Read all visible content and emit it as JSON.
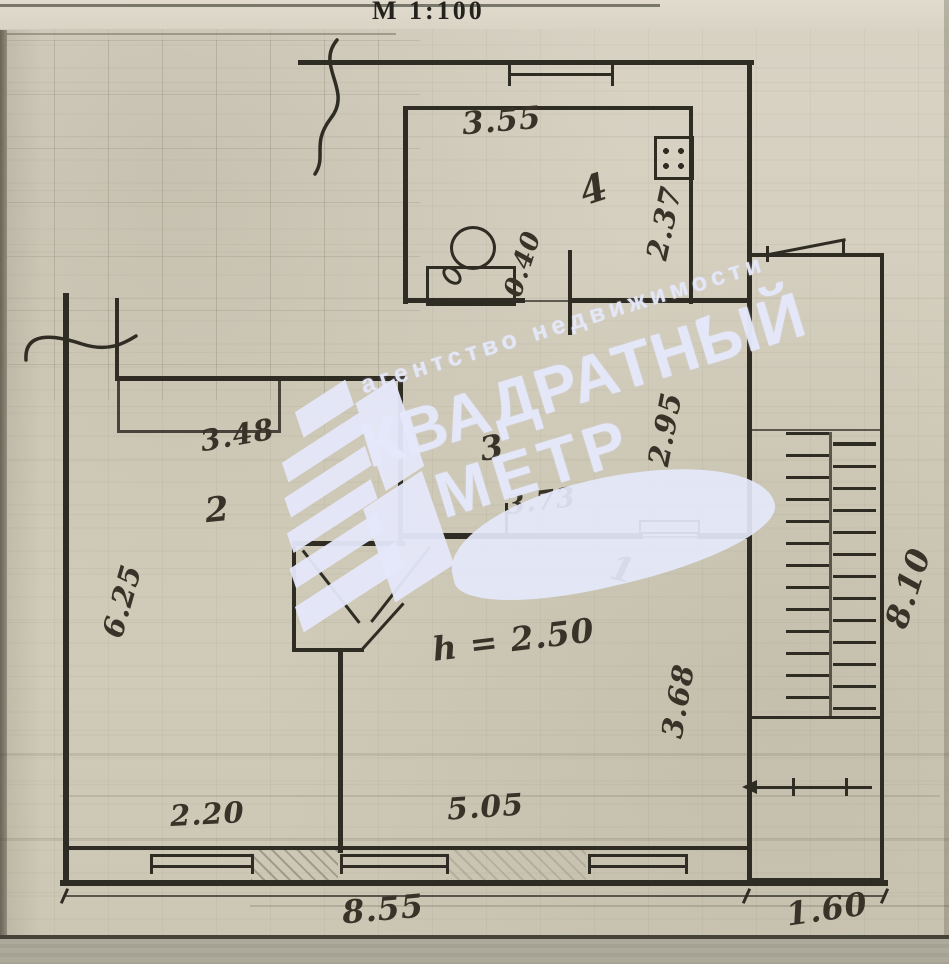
{
  "scale_label": "М 1:100",
  "watermark": {
    "agency_line": "агентство недвижимости",
    "brand_line1": "КВАДРАТНЫЙ",
    "brand_line2": "МЕТР",
    "color": "#e5e8fa"
  },
  "plan": {
    "ceiling_height_note": "h = 2.50",
    "rooms": [
      {
        "number": "1"
      },
      {
        "number": "2"
      },
      {
        "number": "3"
      },
      {
        "number": "4"
      }
    ],
    "dims": {
      "kitchen_width": "3.55",
      "kitchen_depth": "2.37",
      "duct_width": "0.40",
      "hall_depth": "2.95",
      "hall_width": "3.73",
      "room2_width": "3.48",
      "room2_depth": "6.25",
      "room1_width": "5.05",
      "room1_depth": "3.68",
      "room2_bottom_width": "2.20",
      "total_width": "8.55",
      "stair_bay_width": "1.60",
      "stair_depth": "8.10"
    }
  },
  "colors": {
    "ink": "#2f2c24",
    "paper": "#d3cdbc",
    "watermark": "#e5e8fa"
  }
}
